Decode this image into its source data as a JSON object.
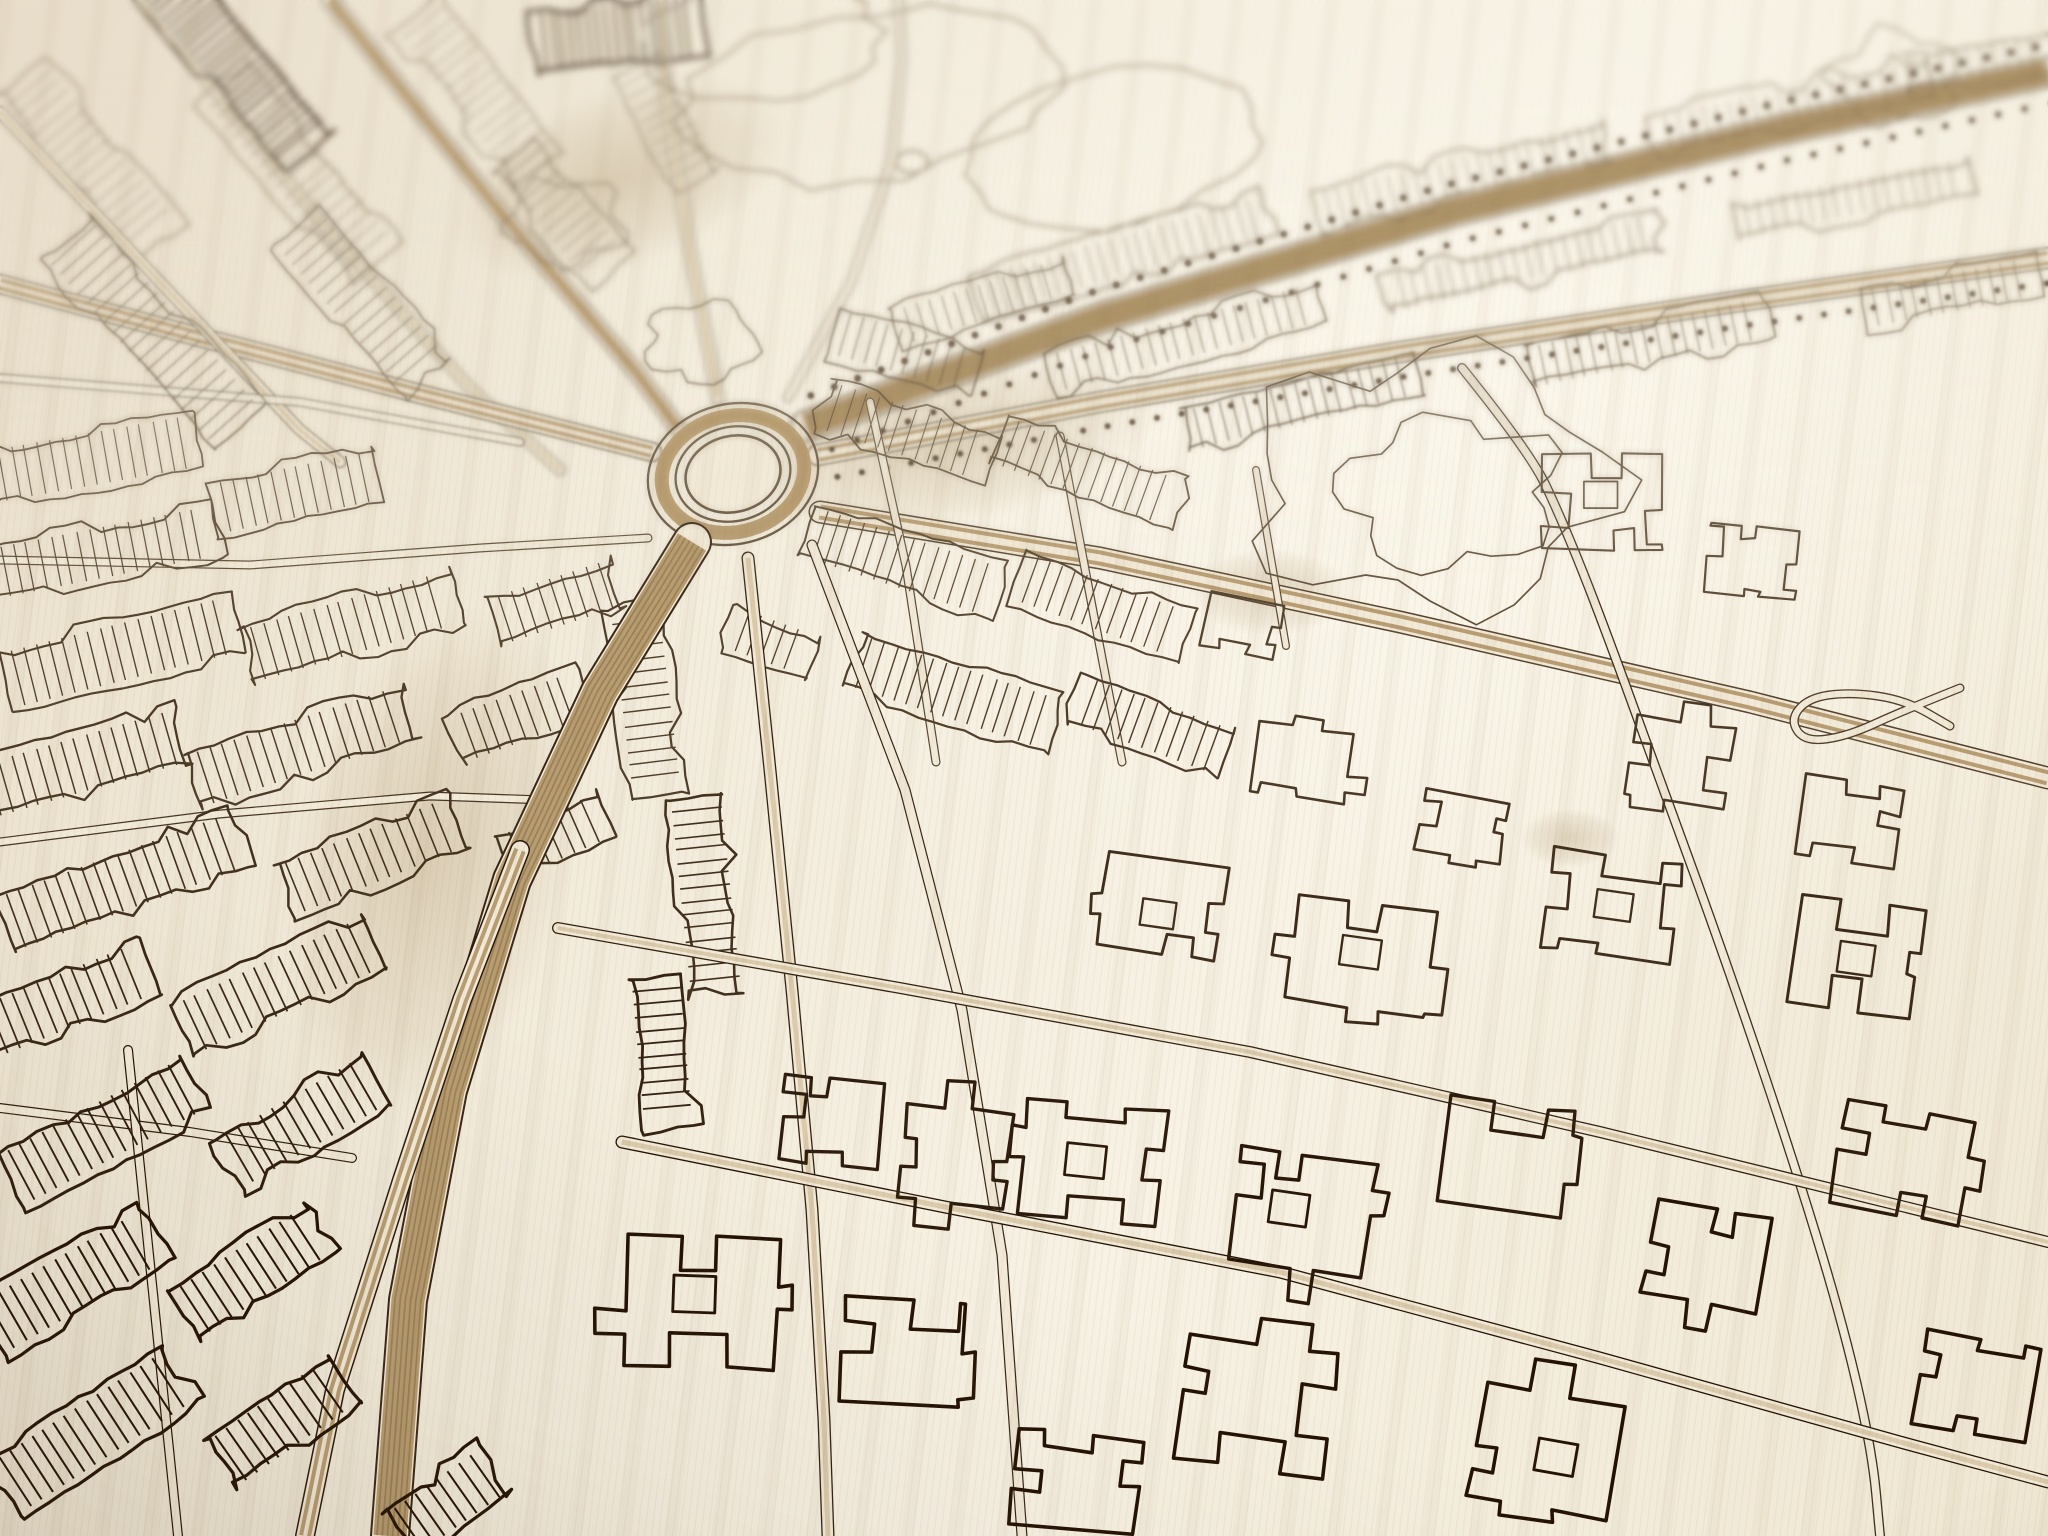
{
  "meta": {
    "description": "Close-up angled photograph of a laser-engraved wooden city map: cream birch wood with burnt dark-brown street and building linework, a central roundabout with radiating boulevards, hatched terraced-house blocks, park areas with tree clumps, and depth-of-field blur toward the top of the photo.",
    "visible_text": "none",
    "object": "wooden-citymap-engraving"
  },
  "palette": {
    "bg_light": "#f8f3e6",
    "bg_mid": "#f0e8d6",
    "bg_dark": "#e5dac2",
    "ink_near": "#231204",
    "ink_far": "#7b6b52",
    "ink_dense": "#3a2817",
    "tan": "#b89d72",
    "tan_deep": "#9b8157",
    "road_fill": "#f2ead8",
    "soft_line": "#95846a",
    "stain": "#8a6631"
  },
  "photo": {
    "blur_top": true,
    "vignette": true,
    "light_from": "top-right",
    "wood_grain_angle_deg": 97
  },
  "map": {
    "canvas": [
      2048,
      1536
    ],
    "roundabout": {
      "cx": 733,
      "cy": 474,
      "rot": -14,
      "ring_rx": 86,
      "ring_ry": 70,
      "inner_rx": 58,
      "inner_ry": 47,
      "island_rx": 48,
      "island_ry": 38,
      "tan_rx": 72,
      "tan_ry": 58
    },
    "roads": [
      {
        "style": "blvd",
        "w": 30,
        "lines": 5,
        "pts": [
          [
            806,
            426
          ],
          [
            1100,
            318
          ],
          [
            1450,
            212
          ],
          [
            1780,
            130
          ],
          [
            2048,
            72
          ]
        ]
      },
      {
        "style": "avenue",
        "w": 22,
        "pts": [
          [
            818,
            455
          ],
          [
            1100,
            402
          ],
          [
            1400,
            352
          ],
          [
            1733,
            302
          ],
          [
            2048,
            258
          ]
        ]
      },
      {
        "style": "blvd",
        "w": 38,
        "lines": 6,
        "pts": [
          [
            692,
            542
          ],
          [
            600,
            692
          ],
          [
            512,
            880
          ],
          [
            448,
            1090
          ],
          [
            408,
            1300
          ],
          [
            390,
            1536
          ]
        ]
      },
      {
        "style": "avenue",
        "w": 20,
        "pts": [
          [
            520,
            850
          ],
          [
            462,
            1000
          ],
          [
            402,
            1180
          ],
          [
            335,
            1390
          ],
          [
            305,
            1536
          ]
        ]
      },
      {
        "style": "avenue",
        "w": 20,
        "pts": [
          [
            652,
            452
          ],
          [
            420,
            394
          ],
          [
            180,
            332
          ],
          [
            0,
            284
          ]
        ]
      },
      {
        "style": "avenue",
        "w": 18,
        "pts": [
          [
            330,
            0
          ],
          [
            500,
            212
          ],
          [
            636,
            372
          ],
          [
            678,
            428
          ]
        ]
      },
      {
        "style": "street",
        "w": 12,
        "pts": [
          [
            140,
            0
          ],
          [
            330,
            232
          ],
          [
            470,
            388
          ],
          [
            560,
            470
          ]
        ]
      },
      {
        "style": "street",
        "w": 12,
        "pts": [
          [
            0,
            112
          ],
          [
            160,
            282
          ],
          [
            300,
            430
          ],
          [
            340,
            462
          ]
        ]
      },
      {
        "style": "street",
        "w": 14,
        "pts": [
          [
            718,
            398
          ],
          [
            690,
            250
          ],
          [
            668,
            108
          ],
          [
            660,
            0
          ]
        ]
      },
      {
        "style": "lane",
        "w": 10,
        "pts": [
          [
            788,
            398
          ],
          [
            852,
            280
          ],
          [
            892,
            160
          ],
          [
            902,
            60
          ],
          [
            898,
            0
          ]
        ]
      },
      {
        "style": "avenue",
        "w": 23,
        "pts": [
          [
            820,
            512
          ],
          [
            1100,
            558
          ],
          [
            1400,
            622
          ],
          [
            1750,
            702
          ],
          [
            2048,
            778
          ]
        ]
      },
      {
        "style": "street",
        "w": 13,
        "pts": [
          [
            748,
            558
          ],
          [
            770,
            770
          ],
          [
            792,
            990
          ],
          [
            812,
            1210
          ],
          [
            824,
            1420
          ],
          [
            828,
            1536
          ]
        ]
      },
      {
        "style": "lane",
        "w": 11,
        "pts": [
          [
            812,
            545
          ],
          [
            905,
            790
          ],
          [
            962,
            1010
          ],
          [
            1002,
            1255
          ],
          [
            1022,
            1536
          ]
        ]
      },
      {
        "style": "street",
        "w": 12,
        "pts": [
          [
            558,
            928
          ],
          [
            900,
            988
          ],
          [
            1250,
            1052
          ],
          [
            1600,
            1132
          ],
          [
            2048,
            1242
          ]
        ]
      },
      {
        "style": "street",
        "w": 13,
        "pts": [
          [
            622,
            1142
          ],
          [
            950,
            1208
          ],
          [
            1280,
            1272
          ],
          [
            1600,
            1358
          ],
          [
            1900,
            1442
          ],
          [
            2048,
            1482
          ]
        ]
      },
      {
        "style": "winding",
        "w": 10,
        "pts": [
          [
            1462,
            368
          ],
          [
            1530,
            452
          ],
          [
            1562,
            520
          ],
          [
            1600,
            615
          ],
          [
            1660,
            780
          ],
          [
            1722,
            950
          ],
          [
            1790,
            1150
          ],
          [
            1842,
            1320
          ],
          [
            1872,
            1450
          ],
          [
            1880,
            1536
          ]
        ]
      },
      {
        "style": "lane",
        "w": 9,
        "pts": [
          [
            0,
            378
          ],
          [
            300,
            402
          ],
          [
            520,
            442
          ]
        ]
      },
      {
        "style": "lane",
        "w": 9,
        "pts": [
          [
            0,
            560
          ],
          [
            250,
            565
          ],
          [
            480,
            548
          ],
          [
            648,
            538
          ]
        ]
      },
      {
        "style": "lane",
        "w": 9,
        "pts": [
          [
            0,
            842
          ],
          [
            220,
            814
          ],
          [
            430,
            796
          ],
          [
            545,
            800
          ]
        ]
      },
      {
        "style": "lane",
        "w": 10,
        "pts": [
          [
            0,
            1108
          ],
          [
            190,
            1132
          ],
          [
            352,
            1158
          ]
        ]
      },
      {
        "style": "lane",
        "w": 10,
        "pts": [
          [
            128,
            1050
          ],
          [
            178,
            1536
          ]
        ]
      },
      {
        "style": "lane",
        "w": 9,
        "pts": [
          [
            870,
            402
          ],
          [
            906,
            566
          ],
          [
            936,
            762
          ]
        ]
      },
      {
        "style": "lane",
        "w": 9,
        "pts": [
          [
            1060,
            436
          ],
          [
            1092,
            606
          ],
          [
            1122,
            762
          ]
        ]
      },
      {
        "style": "lane",
        "w": 8,
        "pts": [
          [
            1256,
            470
          ],
          [
            1286,
            646
          ]
        ]
      },
      {
        "style": "winding",
        "w": 9,
        "pts": [
          [
            1960,
            688
          ],
          [
            1900,
            712
          ],
          [
            1848,
            736
          ],
          [
            1805,
            742
          ],
          [
            1790,
            720
          ],
          [
            1808,
            698
          ],
          [
            1850,
            692
          ],
          [
            1905,
            700
          ],
          [
            1950,
            726
          ]
        ]
      }
    ],
    "tree_rows": [
      {
        "road": 0,
        "offset": -27,
        "spacing": 25,
        "r": 3.4
      },
      {
        "road": 0,
        "offset": 31,
        "spacing": 27,
        "r": 3.1
      },
      {
        "road": 1,
        "offset": 25,
        "spacing": 25,
        "r": 3.0
      }
    ],
    "block_kinds": {
      "0": "terrace-row",
      "1": "dense-terrace",
      "2": "building-outline"
    },
    "blocks": [
      [
        620,
        34,
        170,
        64,
        -6,
        1
      ],
      [
        235,
        62,
        230,
        64,
        50,
        1
      ],
      [
        92,
        162,
        220,
        60,
        50,
        0
      ],
      [
        300,
        172,
        240,
        62,
        50,
        0
      ],
      [
        478,
        92,
        200,
        58,
        52,
        0
      ],
      [
        562,
        214,
        150,
        54,
        50,
        0
      ],
      [
        668,
        122,
        130,
        50,
        62,
        0
      ],
      [
        1122,
        256,
        300,
        44,
        -16,
        0
      ],
      [
        1462,
        176,
        300,
        42,
        -14,
        0
      ],
      [
        1792,
        106,
        280,
        40,
        -12,
        0
      ],
      [
        982,
        302,
        180,
        40,
        -17,
        0
      ],
      [
        1978,
        62,
        150,
        40,
        -10,
        0
      ],
      [
        1185,
        338,
        280,
        42,
        -15,
        0
      ],
      [
        1525,
        262,
        280,
        40,
        -13,
        0
      ],
      [
        1852,
        198,
        240,
        38,
        -11,
        0
      ],
      [
        152,
        332,
        260,
        64,
        48,
        0
      ],
      [
        362,
        302,
        200,
        60,
        49,
        0
      ],
      [
        905,
        352,
        150,
        48,
        16,
        0
      ],
      [
        1302,
        402,
        240,
        44,
        -14,
        0
      ],
      [
        1648,
        342,
        240,
        44,
        -12,
        0
      ],
      [
        1952,
        292,
        180,
        42,
        -11,
        0
      ],
      [
        75,
        462,
        250,
        56,
        -10,
        0
      ],
      [
        105,
        552,
        230,
        54,
        -11,
        0
      ],
      [
        295,
        492,
        170,
        54,
        -12,
        0
      ],
      [
        908,
        432,
        180,
        52,
        18,
        0
      ],
      [
        1088,
        472,
        190,
        52,
        20,
        0
      ],
      [
        902,
        562,
        200,
        55,
        18,
        0
      ],
      [
        1102,
        606,
        180,
        52,
        20,
        0
      ],
      [
        952,
        692,
        210,
        56,
        18,
        0
      ],
      [
        1152,
        726,
        160,
        52,
        20,
        0
      ],
      [
        122,
        652,
        240,
        60,
        -14,
        0
      ],
      [
        352,
        626,
        220,
        58,
        -16,
        0
      ],
      [
        556,
        602,
        130,
        52,
        -18,
        0
      ],
      [
        82,
        764,
        210,
        58,
        -16,
        0
      ],
      [
        302,
        746,
        230,
        58,
        -18,
        0
      ],
      [
        522,
        716,
        140,
        52,
        -20,
        0
      ],
      [
        122,
        882,
        250,
        60,
        -20,
        0
      ],
      [
        372,
        856,
        190,
        56,
        -22,
        0
      ],
      [
        556,
        836,
        110,
        50,
        -24,
        0
      ],
      [
        646,
        702,
        190,
        52,
        83,
        0
      ],
      [
        706,
        896,
        200,
        54,
        84,
        0
      ],
      [
        772,
        642,
        90,
        46,
        20,
        0
      ],
      [
        1602,
        502,
        120,
        95,
        0,
        2
      ],
      [
        1752,
        562,
        90,
        70,
        5,
        2
      ],
      [
        1302,
        762,
        95,
        70,
        8,
        2
      ],
      [
        1462,
        826,
        85,
        62,
        10,
        2
      ],
      [
        1242,
        626,
        75,
        55,
        12,
        2
      ],
      [
        1680,
        762,
        100,
        80,
        8,
        2
      ],
      [
        1850,
        822,
        100,
        80,
        9,
        2
      ],
      [
        62,
        1002,
        190,
        58,
        -22,
        0
      ],
      [
        278,
        986,
        210,
        58,
        -25,
        0
      ],
      [
        102,
        1132,
        210,
        60,
        -28,
        0
      ],
      [
        302,
        1122,
        170,
        58,
        -30,
        0
      ],
      [
        72,
        1282,
        190,
        60,
        -30,
        0
      ],
      [
        252,
        1272,
        160,
        58,
        -33,
        0
      ],
      [
        92,
        1432,
        210,
        62,
        -33,
        0
      ],
      [
        282,
        1422,
        150,
        58,
        -35,
        0
      ],
      [
        448,
        1502,
        120,
        55,
        -35,
        0
      ],
      [
        662,
        1052,
        150,
        52,
        85,
        0
      ],
      [
        702,
        1302,
        150,
        130,
        2,
        2
      ],
      [
        902,
        1352,
        120,
        105,
        4,
        2
      ],
      [
        1092,
        1162,
        140,
        115,
        6,
        2
      ],
      [
        1302,
        1212,
        135,
        115,
        8,
        2
      ],
      [
        1506,
        1156,
        125,
        105,
        8,
        2
      ],
      [
        1256,
        1406,
        150,
        125,
        8,
        2
      ],
      [
        1546,
        1452,
        140,
        115,
        10,
        2
      ],
      [
        1076,
        1482,
        125,
        95,
        6,
        2
      ],
      [
        1706,
        1256,
        115,
        95,
        10,
        2
      ],
      [
        1902,
        1162,
        130,
        105,
        10,
        2
      ],
      [
        1856,
        956,
        125,
        110,
        8,
        2
      ],
      [
        1612,
        906,
        130,
        100,
        8,
        2
      ],
      [
        1362,
        956,
        140,
        105,
        8,
        2
      ],
      [
        1162,
        906,
        120,
        95,
        8,
        2
      ],
      [
        956,
        1156,
        105,
        95,
        6,
        2
      ],
      [
        1976,
        1386,
        115,
        95,
        10,
        2
      ],
      [
        832,
        1122,
        100,
        85,
        5,
        2
      ]
    ],
    "blobs": [
      [
        700,
        342,
        48
      ],
      [
        565,
        222,
        50
      ],
      [
        1430,
        480,
        150
      ],
      [
        1895,
        78,
        55
      ]
    ],
    "park_paths": [
      [
        870,
        95,
        190,
        85,
        -8
      ],
      [
        1110,
        150,
        150,
        75,
        -10
      ],
      [
        758,
        42,
        120,
        60,
        -5
      ]
    ],
    "ponds": [
      [
        912,
        162,
        16,
        11
      ]
    ],
    "stains": [
      [
        950,
        445,
        210,
        80,
        -10
      ],
      [
        430,
        860,
        140,
        260,
        14
      ],
      [
        1270,
        592,
        80,
        44,
        0
      ],
      [
        620,
        178,
        180,
        90,
        -20
      ],
      [
        1570,
        838,
        50,
        30,
        0
      ]
    ]
  }
}
